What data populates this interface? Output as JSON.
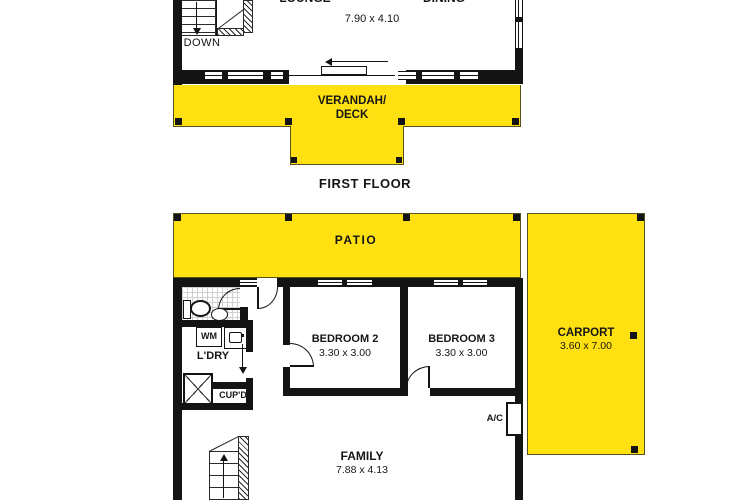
{
  "colors": {
    "outdoor_fill": "#FFE112",
    "wall": "#141414",
    "outdoor_outline": "#57511F"
  },
  "icons": {
    "stairs_down_arrow": "arrow-down",
    "stairs_up_arrow": "arrow-up",
    "hall_direction_arrow": "arrow-down",
    "sliding_door_arrow": "arrow-left"
  },
  "first_floor": {
    "caption": "FIRST FLOOR",
    "lounge_label": "LOUNGE",
    "dining_label": "DINING",
    "lounge_dining_dim": "7.90 x 4.10",
    "stairs_label": "DOWN",
    "verandah_line1": "VERANDAH/",
    "verandah_line2": "DECK"
  },
  "ground_floor": {
    "patio_label": "PATIO",
    "carport_label": "CARPORT",
    "carport_dim": "3.60 x 7.00",
    "bedroom2_label": "BEDROOM 2",
    "bedroom2_dim": "3.30 x 3.00",
    "bedroom3_label": "BEDROOM 3",
    "bedroom3_dim": "3.30 x 3.00",
    "laundry_label": "L'DRY",
    "washing_machine_label": "WM",
    "cupboard_label": "CUP'D",
    "ac_label": "A/C",
    "family_label": "FAMILY",
    "family_dim": "7.88 x 4.13"
  }
}
